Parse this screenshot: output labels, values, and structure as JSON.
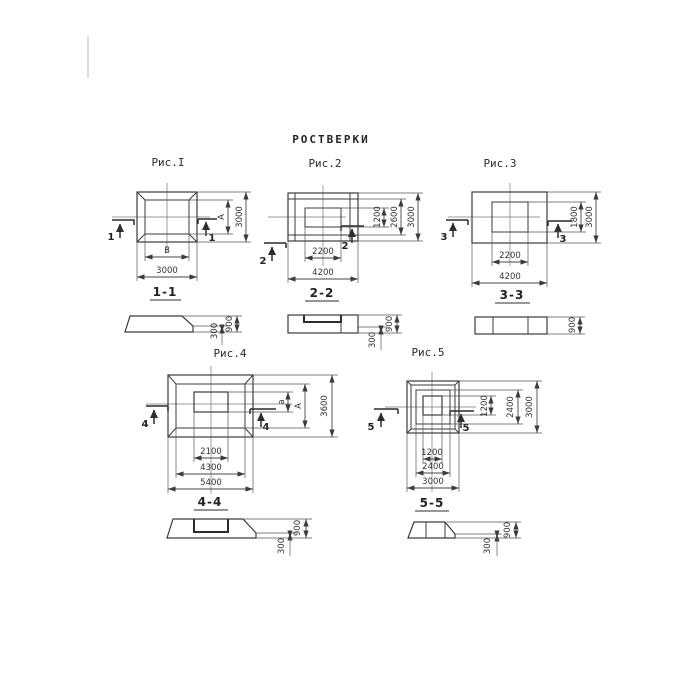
{
  "title": "РОСТВЕРКИ",
  "figures": {
    "fig1": {
      "label": "Рис.I",
      "cut_mark": "1",
      "section_label": "1-1",
      "plan_dims": {
        "inner_width": "B",
        "outer_width": "3000",
        "inner_height": "A",
        "outer_height": "3000"
      },
      "section_dims": {
        "total_height": "900",
        "edge_height": "300"
      }
    },
    "fig2": {
      "label": "Рис.2",
      "cut_mark": "2",
      "section_label": "2-2",
      "plan_dims": {
        "inner_width": "2200",
        "outer_width": "4200",
        "inner_height": "1200",
        "mid_height": "2600",
        "outer_height": "3000"
      },
      "section_dims": {
        "total_height": "900",
        "edge_height": "300"
      }
    },
    "fig3": {
      "label": "Рис.3",
      "cut_mark": "3",
      "section_label": "3-3",
      "plan_dims": {
        "inner_width": "2200",
        "outer_width": "4200",
        "inner_height": "1800",
        "outer_height": "3000"
      },
      "section_dims": {
        "total_height": "900"
      }
    },
    "fig4": {
      "label": "Рис.4",
      "cut_mark": "4",
      "section_label": "4-4",
      "plan_dims": {
        "inner_width": "2100",
        "mid_width": "4300",
        "outer_width": "5400",
        "inner_height": "a",
        "mid_height": "A",
        "outer_height": "3600"
      },
      "section_dims": {
        "total_height": "900",
        "edge_height": "300"
      }
    },
    "fig5": {
      "label": "Рис.5",
      "cut_mark": "5",
      "section_label": "5-5",
      "plan_dims": {
        "inner_width": "1200",
        "mid_width": "2400",
        "outer_width": "3000",
        "inner_height": "1200",
        "mid_height": "2400",
        "outer_height": "3000"
      },
      "section_dims": {
        "total_height": "900",
        "edge_height": "300"
      }
    }
  },
  "colors": {
    "background": "#ffffff",
    "line": "#3b3b3b"
  }
}
